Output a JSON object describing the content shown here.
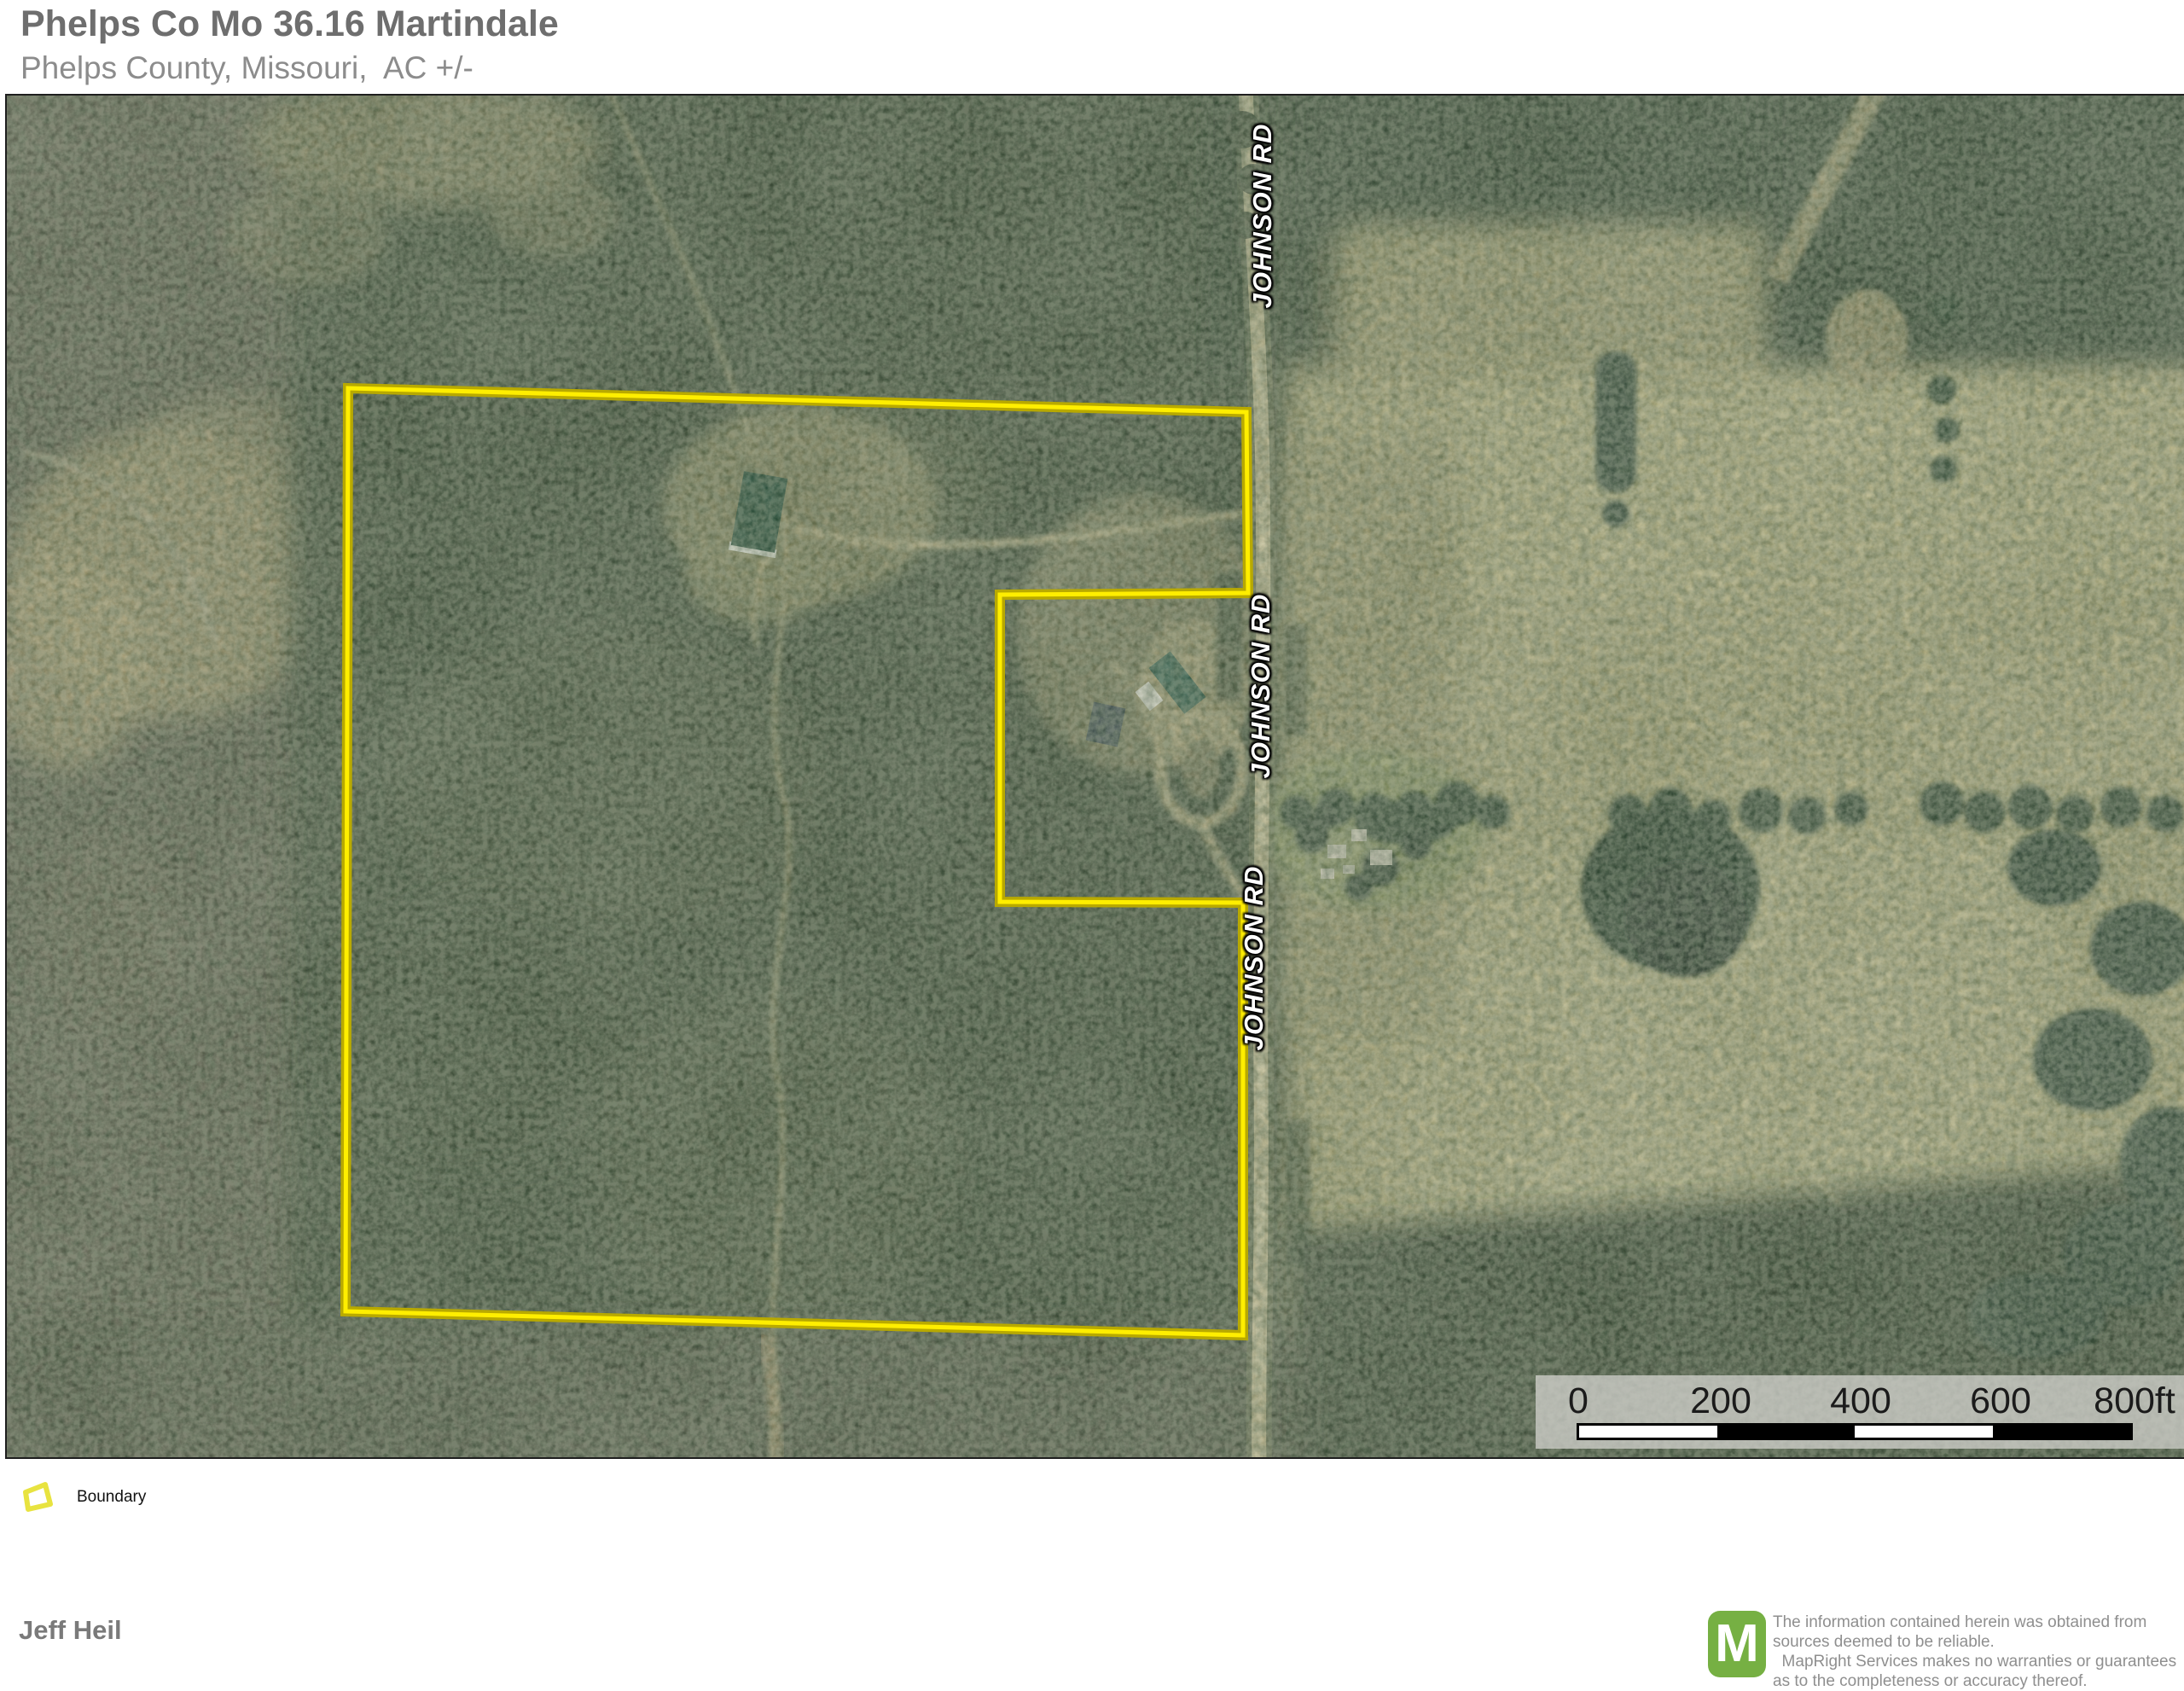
{
  "header": {
    "title": "Phelps Co Mo 36.16 Martindale",
    "subtitle": "Phelps County, Missouri,  AC +/-"
  },
  "map": {
    "road_label": "JOHNSON RD",
    "boundary_points": "400,343 1453,371 1455,583 1164,585 1164,945 1449,946 1449,1453 397,1425",
    "boundary_color_core": "#ffee00",
    "boundary_color_edge": "#b8a900"
  },
  "scalebar": {
    "labels": [
      "0",
      "200",
      "400",
      "600",
      "800ft"
    ]
  },
  "legend": {
    "items": [
      {
        "label": "Boundary"
      }
    ]
  },
  "footer": {
    "attribution": "Jeff Heil",
    "logo_letter": "M",
    "logo_color": "#76b043",
    "disclaimer_lines": [
      "The information contained herein was obtained from",
      "sources deemed to be reliable.",
      "  MapRight Services makes no warranties or guarantees",
      "as to the completeness or accuracy thereof."
    ]
  }
}
